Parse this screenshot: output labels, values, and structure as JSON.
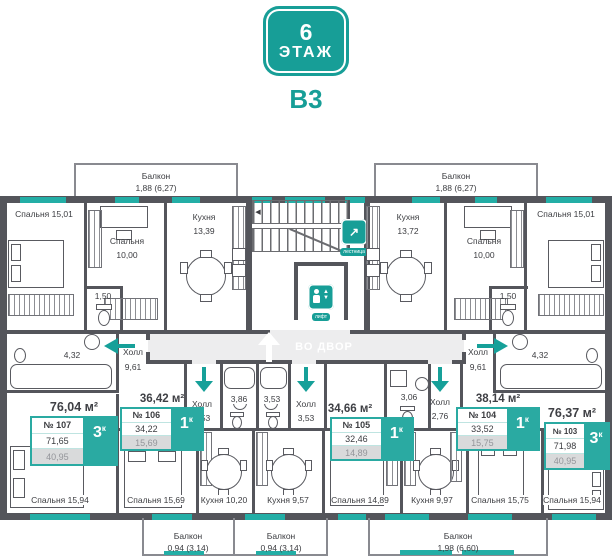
{
  "header": {
    "floor_number": "6",
    "floor_label": "ЭТАЖ",
    "section": "В3"
  },
  "core": {
    "courtyard": "ВО ДВОР",
    "stairs": "лестница",
    "lift": "лифт"
  },
  "cards": {
    "k": "к"
  },
  "apartments": [
    {
      "number": "№ 107",
      "rooms": "3",
      "total": "76,04 м²",
      "area1": "71,65",
      "area2": "40,95"
    },
    {
      "number": "№ 106",
      "rooms": "1",
      "total": "36,42 м²",
      "area1": "34,22",
      "area2": "15,69"
    },
    {
      "number": "№ 105",
      "rooms": "1",
      "total": "34,66 м²",
      "area1": "32,46",
      "area2": "14,89"
    },
    {
      "number": "№ 104",
      "rooms": "1",
      "total": "38,14 м²",
      "area1": "33,52",
      "area2": "15,75"
    },
    {
      "number": "№ 103",
      "rooms": "3",
      "total": "76,37 м²",
      "area1": "71,98",
      "area2": "40,95"
    }
  ],
  "rooms": {
    "balcony_name": "Балкон",
    "balcony_top": "1,88 (6,27)",
    "balcony_small": "0,94 (3,14)",
    "balcony_big": "1,98 (6,60)",
    "bedroom_tl": "Спальня 15,01",
    "bedroom_tr": "Спальня 15,01",
    "bedroom_name": "Спальня",
    "bedroom10": "10,00",
    "kitchen_name": "Кухня",
    "kitchen_l": "13,39",
    "kitchen_r": "13,72",
    "wc": "1,50",
    "bath": "4,32",
    "hall_name": "Холл",
    "hall9": "9,61",
    "hall353": "3,53",
    "bath386": "3,86",
    "bath353": "3,53",
    "bath306": "3,06",
    "hall276": "2,76",
    "b107": "Спальня 15,94",
    "b106": "Спальня 15,69",
    "k106": "Кухня 10,20",
    "k105": "Кухня 9,57",
    "b105": "Спальня 14,89",
    "k104": "Кухня 9,97",
    "b104": "Спальня 15,75",
    "b103": "Спальня 15,94"
  }
}
